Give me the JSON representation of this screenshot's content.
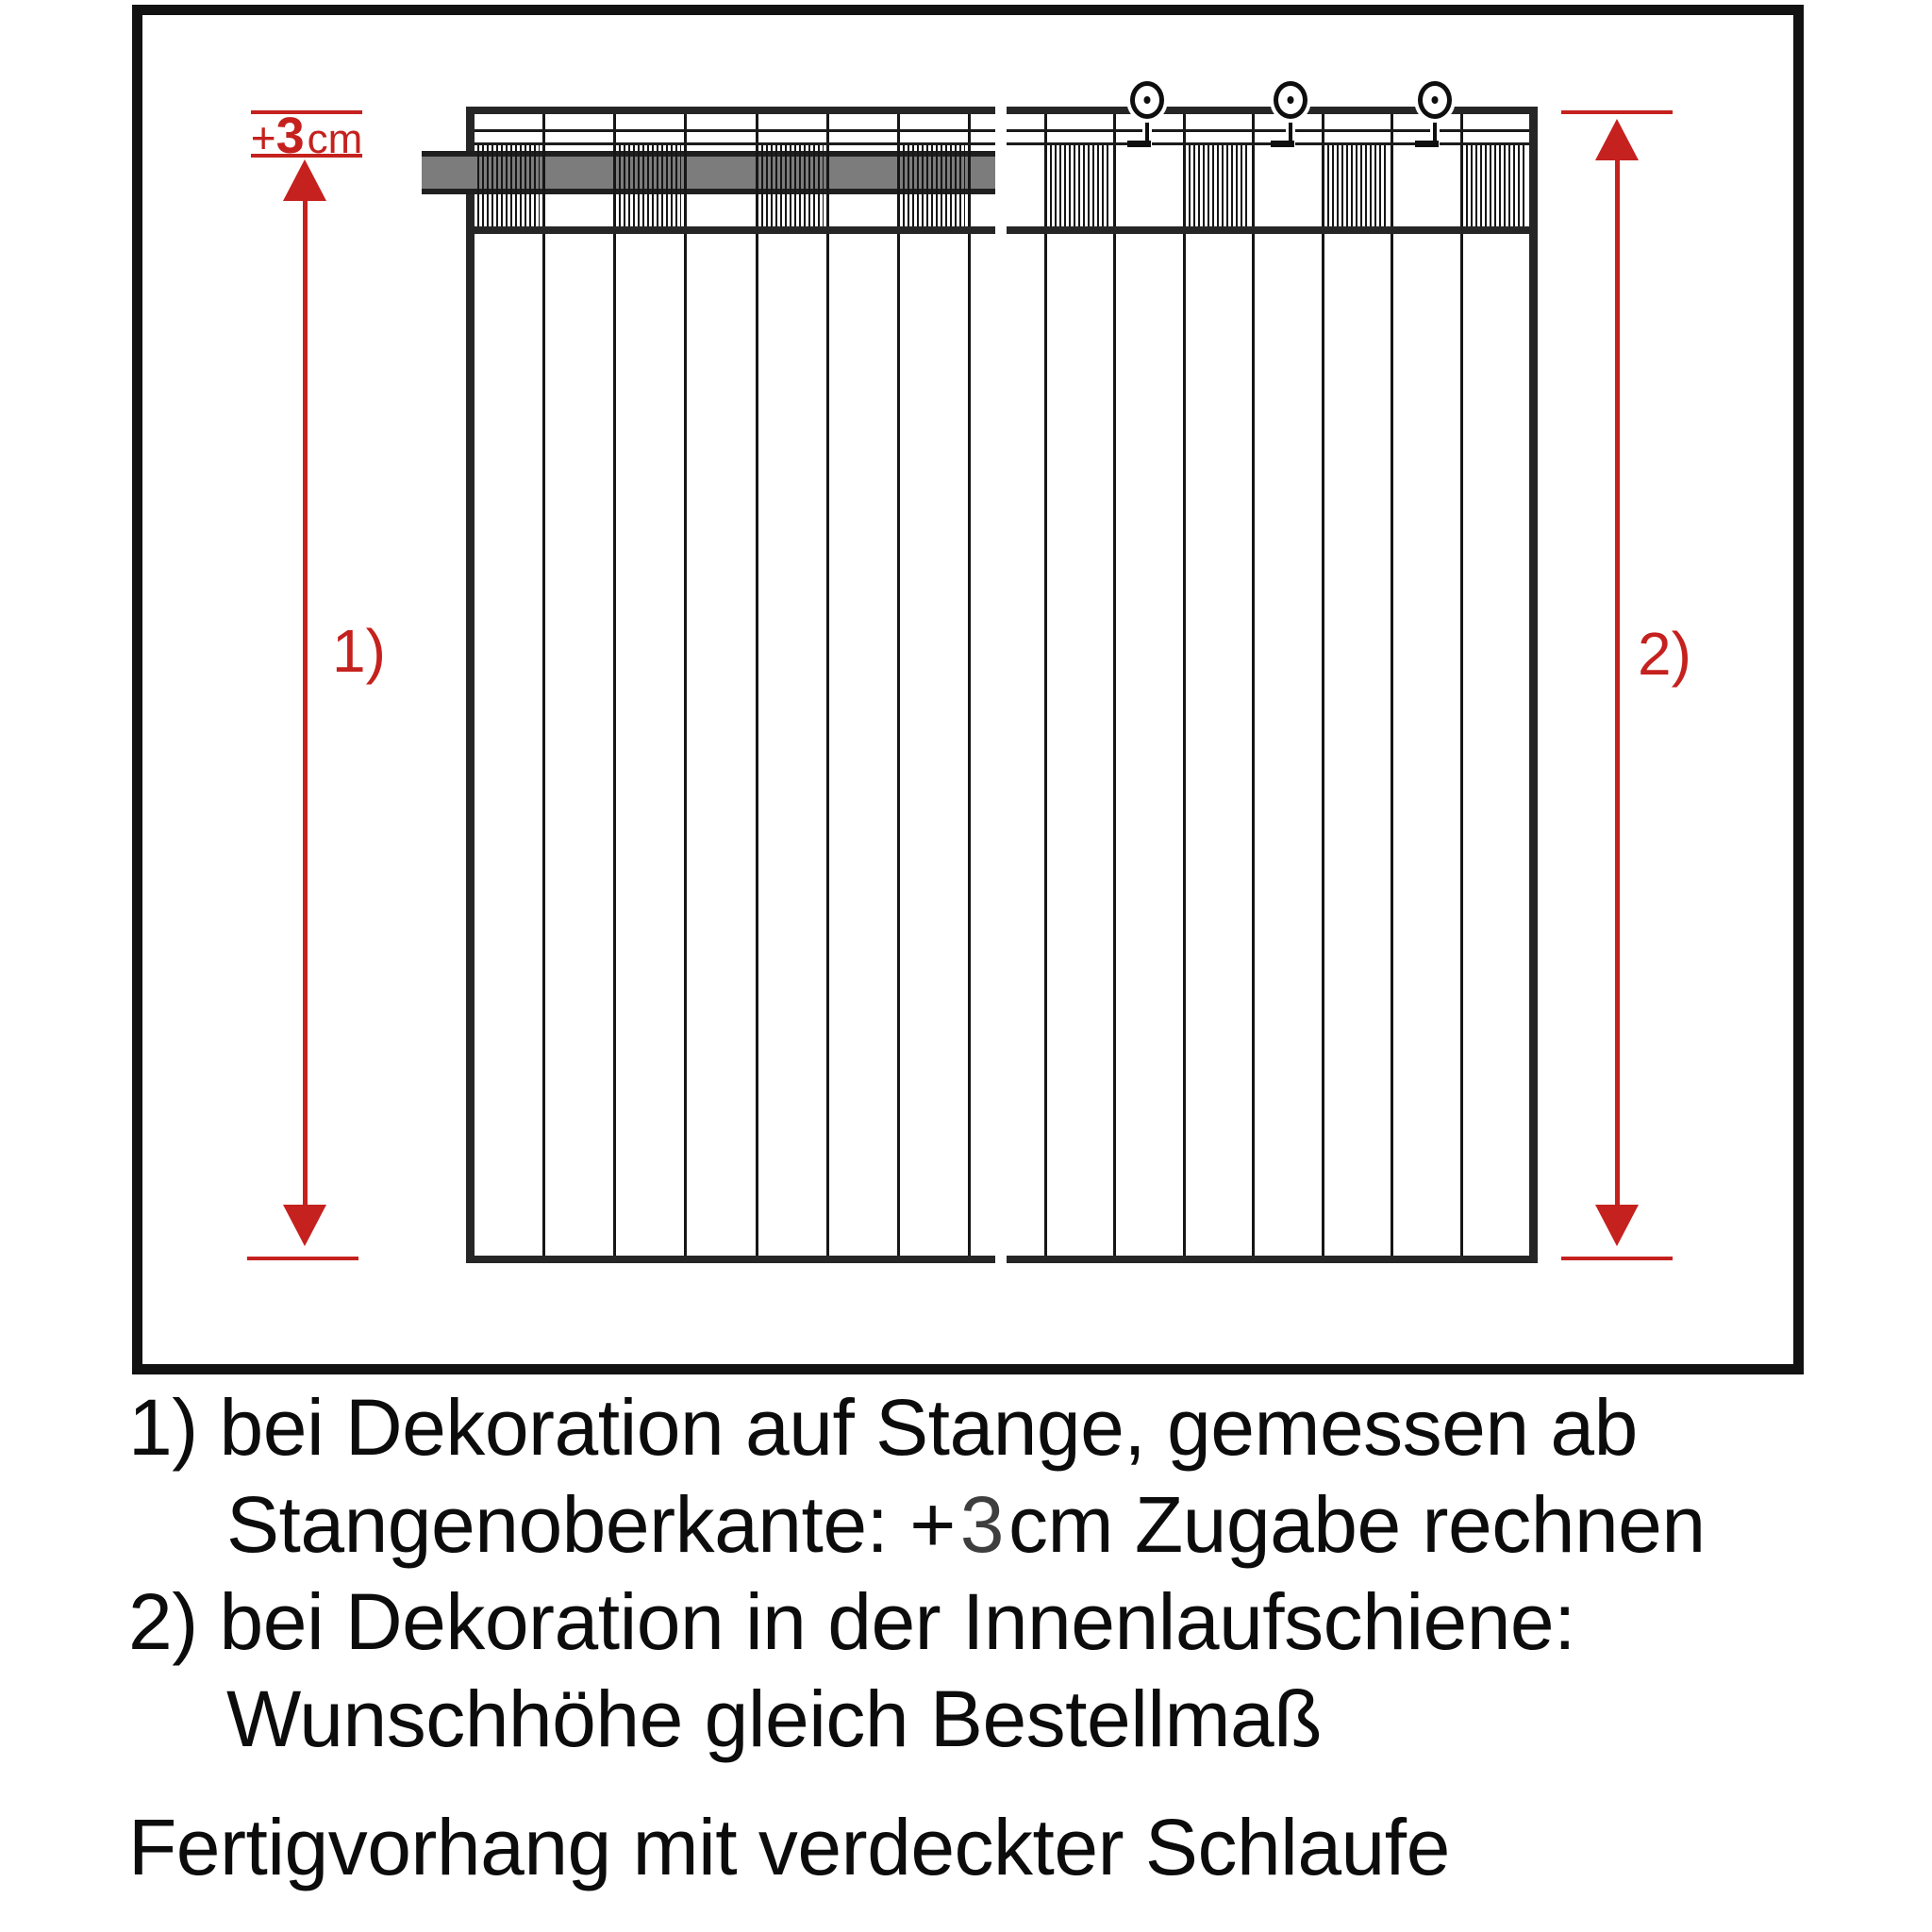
{
  "figure": {
    "colors": {
      "red": "#c5211e",
      "line": "#161616",
      "rod_gray": "#7c7c7c",
      "rod_edge": "#1f1f1f"
    },
    "plus3cm": {
      "plus": "+",
      "value": "3",
      "unit": "cm"
    },
    "arrow1_label": "1)",
    "arrow2_label": "2)",
    "left_panel": {
      "cells": 8,
      "hatched": [
        0,
        2,
        4,
        6
      ],
      "narrow_last": true
    },
    "right_panel": {
      "cells": 8,
      "hatched": [
        1,
        3,
        5,
        7
      ],
      "narrow_first": true,
      "ring_x": [
        1216,
        1368,
        1521
      ]
    }
  },
  "caption": {
    "line1": "1) bei Dekoration auf Stange, gemessen ab",
    "line2_prefix": "Stangenoberkante: +",
    "line2_value": "3",
    "line2_suffix": "cm Zugabe rechnen",
    "line3": "2) bei Dekoration in der Innenlaufschiene:",
    "line4": "Wunschhöhe gleich Bestellmaß",
    "line5": "Fertigvorhang mit verdeckter Schlaufe"
  }
}
